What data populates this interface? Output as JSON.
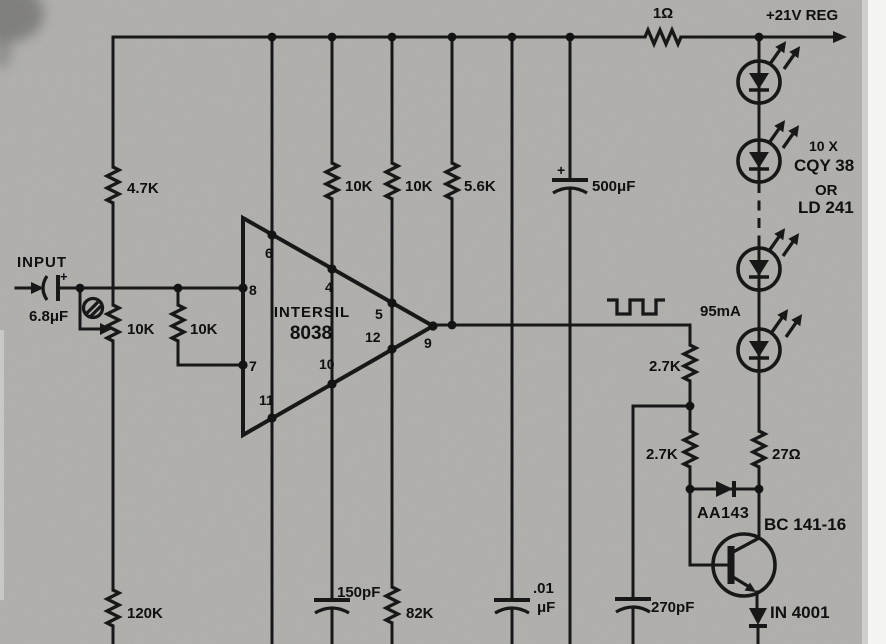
{
  "colors": {
    "paper": "#b0afac",
    "ink": "#181818"
  },
  "power": {
    "series_resistor": "1Ω",
    "rail_label": "+21V REG"
  },
  "bias": {
    "r_4k7": "4.7K",
    "r_10k_a": "10K",
    "r_10k_b": "10K",
    "r_5k6": "5.6K",
    "c_500u_plus": "+",
    "c_500u": "500μF"
  },
  "input": {
    "label": "INPUT",
    "c_6u8_plus": "+",
    "c_6u8": "6.8μF",
    "pot_10k": "10K",
    "r_10k": "10K"
  },
  "ic": {
    "maker": "INTERSIL",
    "part": "8038",
    "pin4": "4",
    "pin5": "5",
    "pin6": "6",
    "pin7": "7",
    "pin8": "8",
    "pin9": "9",
    "pin10": "10",
    "pin11": "11",
    "pin12": "12"
  },
  "output": {
    "current": "95mA"
  },
  "leds": {
    "qty": "10 X",
    "part_a": "CQY 38",
    "conj": "OR",
    "part_b": "LD 241"
  },
  "driver": {
    "r_2k7_top": "2.7K",
    "r_2k7_bot": "2.7K",
    "r_27": "27Ω",
    "clamp": "AA143",
    "transistor": "BC 141-16",
    "rectifier": "IN 4001"
  },
  "timing": {
    "r_120k": "120K",
    "c_150p": "150pF",
    "r_82k": "82K",
    "c_10n_a": ".01",
    "c_10n_b": "μF",
    "c_270p": "270pF"
  }
}
